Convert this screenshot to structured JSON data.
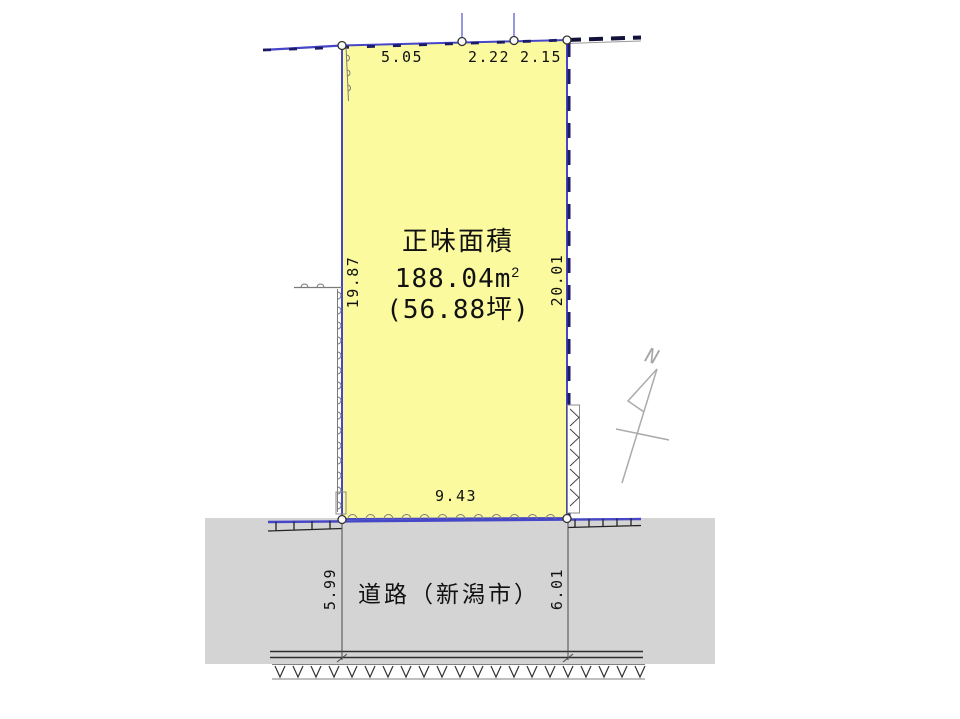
{
  "colors": {
    "parcel_fill": "#FBFA9E",
    "road_fill": "#D4D4D4",
    "boundary_blue": "#4646C8",
    "boundary_navy_dash": "#1B1B66",
    "hatch_gray": "#7A7A7A",
    "north_arrow_gray": "#ABABAB",
    "text_color": "#111111"
  },
  "parcel": {
    "area_title": "正味面積",
    "area_value": "188.04m",
    "area_value_sup": "2",
    "area_tsubo": "(56.88坪)",
    "dim_top_1": "5.05",
    "dim_top_2": "2.22",
    "dim_top_3": "2.15",
    "dim_left": "19.87",
    "dim_right": "20.01",
    "dim_bottom": "9.43"
  },
  "road": {
    "label": "道路（新潟市）",
    "dim_left": "5.99",
    "dim_right": "6.01"
  },
  "compass": {
    "north_label": "N"
  }
}
